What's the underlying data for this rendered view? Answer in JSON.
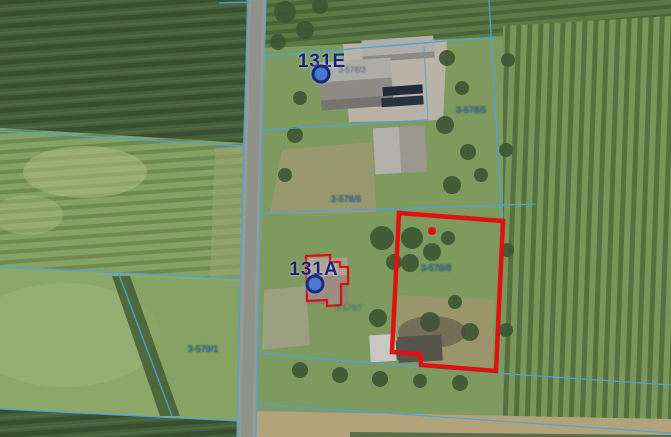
{
  "map": {
    "address_points": [
      {
        "label": "131E"
      },
      {
        "label": "131A"
      }
    ],
    "parcel_labels": [
      {
        "number": "3-578/3"
      },
      {
        "number": "3-578/5"
      },
      {
        "number": "3-578/6"
      },
      {
        "number": "3-578/8"
      },
      {
        "number": "3-578/7"
      },
      {
        "number": "3-579/1"
      }
    ],
    "highlighted_parcel": {
      "number": "3-578/8",
      "outline_color": "#e01111"
    },
    "colors": {
      "parcel_boundary_line": "#4da3dd",
      "parcel_label_text": "#2e6cb2",
      "address_label_text": "#16246d",
      "address_marker_fill": "#4a77d4",
      "address_marker_border": "#1d2b69",
      "highlight_red": "#e01111"
    }
  }
}
